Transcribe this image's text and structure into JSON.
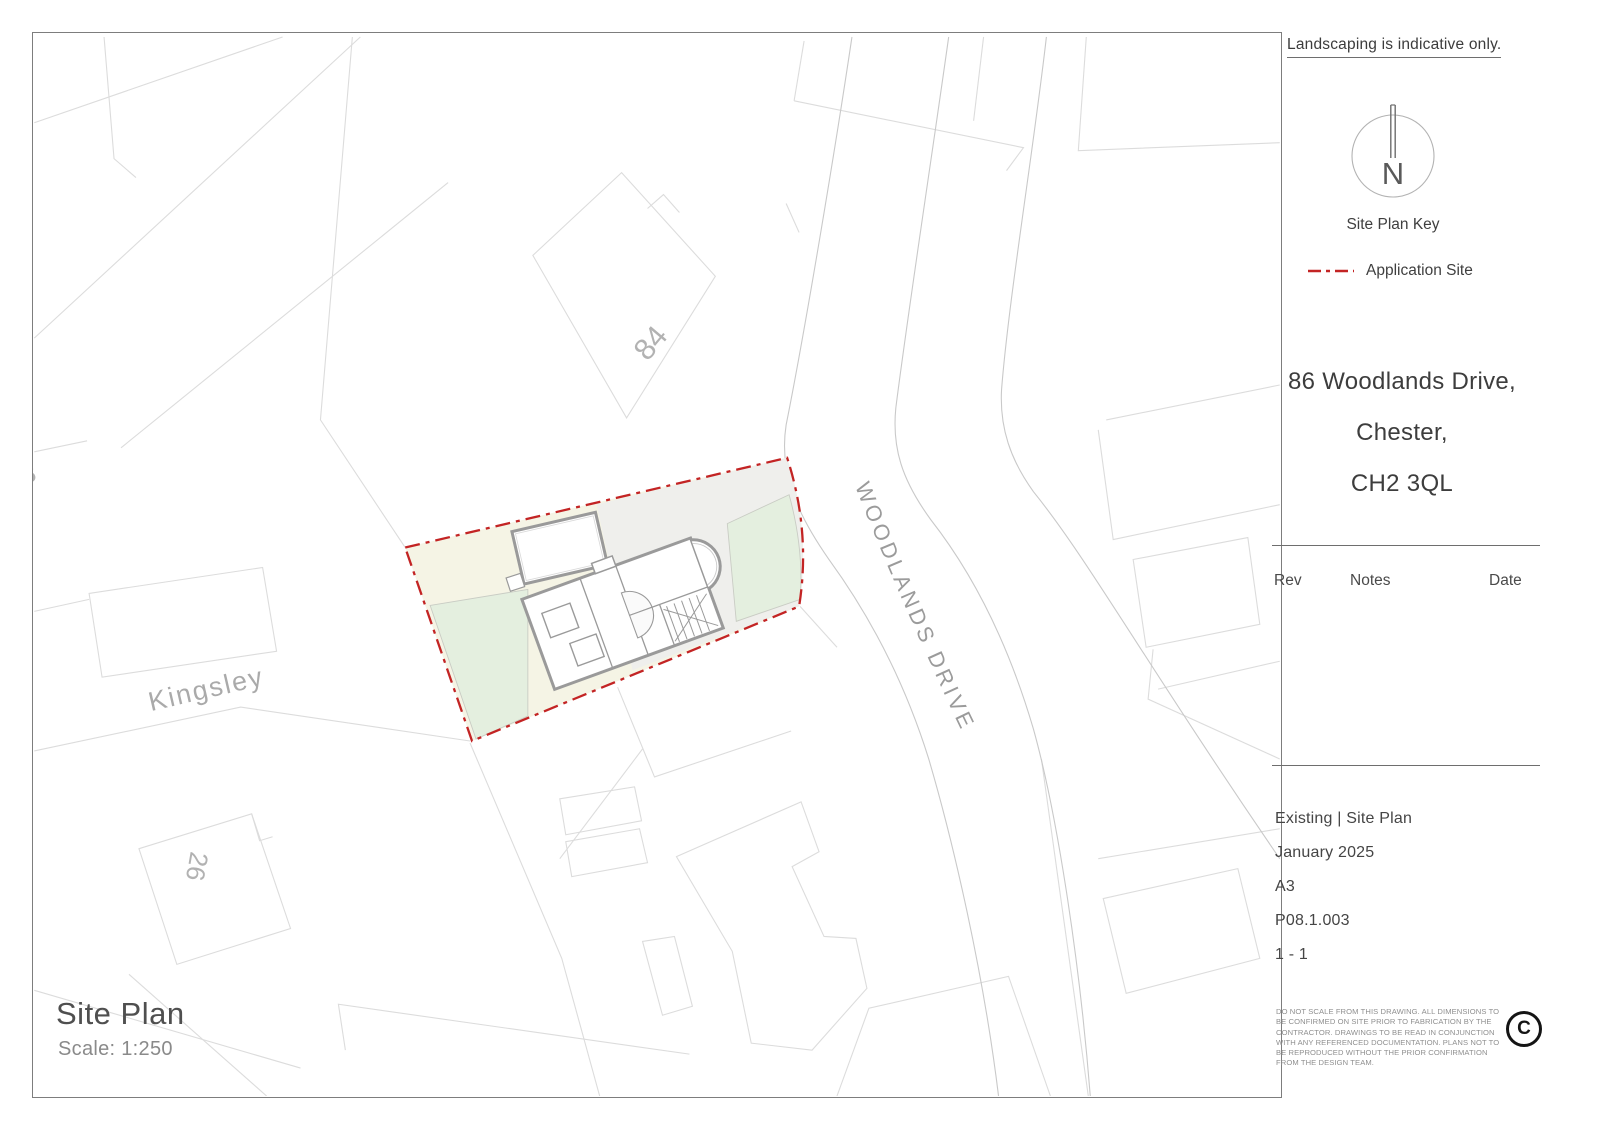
{
  "title_block": {
    "note": "Landscaping is indicative only.",
    "north_label": "N",
    "key_title": "Site Plan Key",
    "legend": {
      "application_site_label": "Application Site",
      "application_site_color": "#c32424",
      "style": "dash-dot"
    },
    "address_lines": {
      "line1": "86 Woodlands Drive,",
      "line2": "Chester,",
      "line3": "CH2 3QL"
    },
    "revision_table": {
      "headers": [
        "Rev",
        "Notes",
        "Date"
      ]
    },
    "drawing_info": {
      "drawing_title": "Existing | Site Plan",
      "date": "January 2025",
      "paper_size": "A3",
      "drawing_number": "P08.1.003",
      "revision": "1 - 1"
    },
    "disclaimer": "DO NOT SCALE FROM THIS DRAWING. ALL DIMENSIONS TO BE CONFIRMED ON SITE PRIOR TO FABRICATION BY THE CONTRACTOR. DRAWINGS TO BE READ IN CONJUNCTION WITH ANY REFERENCED DOCUMENTATION. PLANS NOT TO BE REPRODUCED WITHOUT THE PRIOR CONFIRMATION FROM THE DESIGN TEAM.",
    "copyright_symbol": "C"
  },
  "plan": {
    "caption_title": "Site Plan",
    "caption_scale": "Scale: 1:250",
    "road_label": "WOODLANDS DRIVE",
    "street_label": "Kingsley",
    "house_numbers": [
      "84",
      "26",
      "8"
    ],
    "colors": {
      "application_site_red": "#c32424",
      "garden_cream": "#f5f4e5",
      "lawn_green": "#e4efdf",
      "driveway_grey": "#efefec",
      "parcel_line_grey": "#dcdcdc",
      "building_wall_grey": "#9a9a9a"
    }
  }
}
